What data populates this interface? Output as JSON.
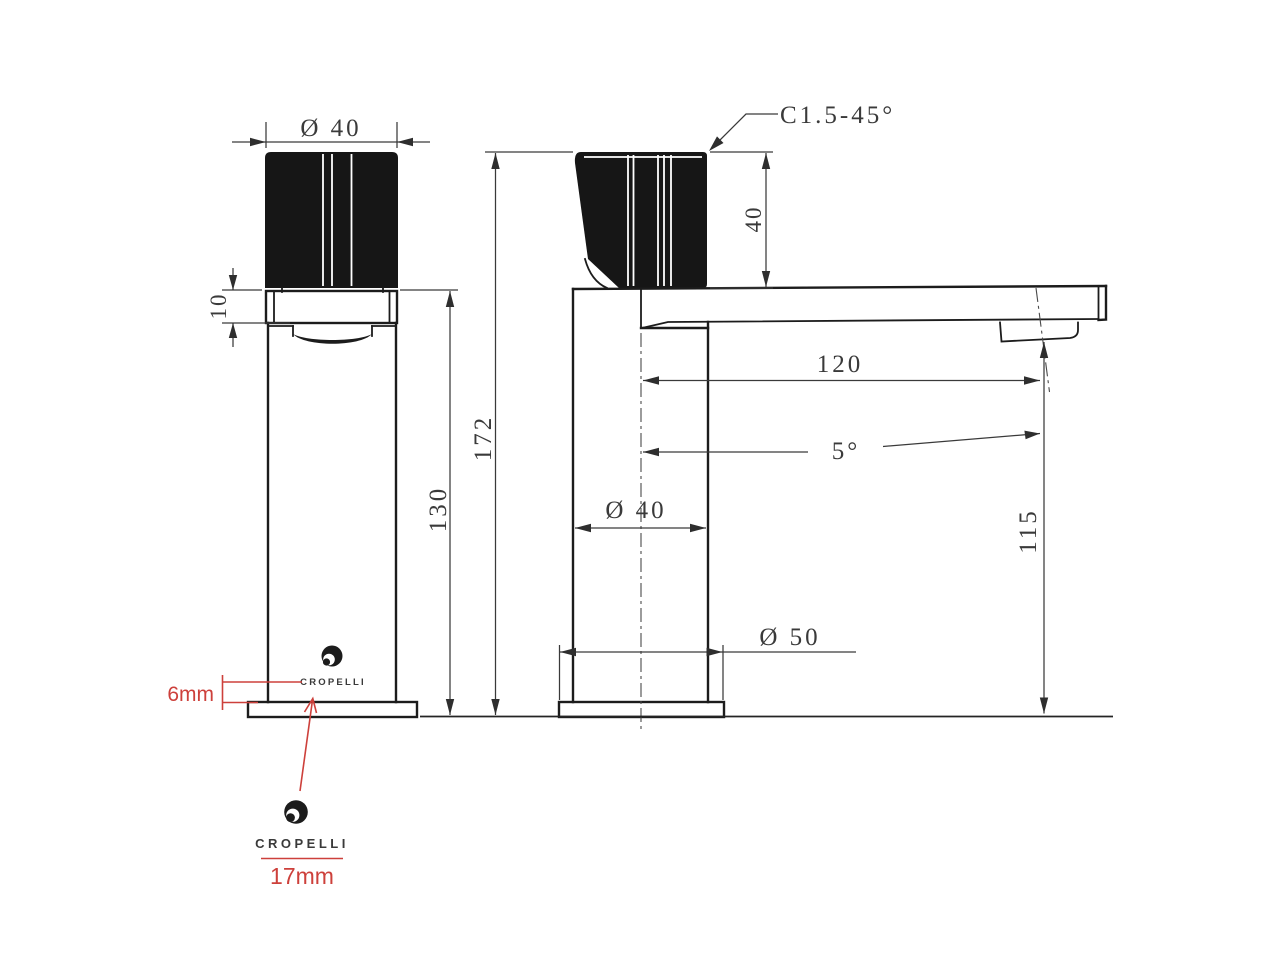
{
  "drawing": {
    "kind": "faucet technical drawing",
    "colors": {
      "line": "#1c1c1c",
      "dim": "#3a3a3a",
      "red": "#cd403b"
    }
  },
  "front_view": {
    "dims": {
      "handle_diameter": "Ø 40",
      "collar_height": "10",
      "body_height": "130",
      "overall_height": "172"
    }
  },
  "side_view": {
    "dims": {
      "chamfer": "C1.5-45°",
      "handle_height": "40",
      "spout_reach": "120",
      "spout_angle": "5°",
      "body_diameter": "Ø 40",
      "underspout_height": "115",
      "base_diameter": "Ø 50"
    }
  },
  "annotations": {
    "small_logo_size": "6mm",
    "large_logo_size": "17mm",
    "brand_small": "CROPELLI",
    "brand_large": "CROPELLI"
  }
}
